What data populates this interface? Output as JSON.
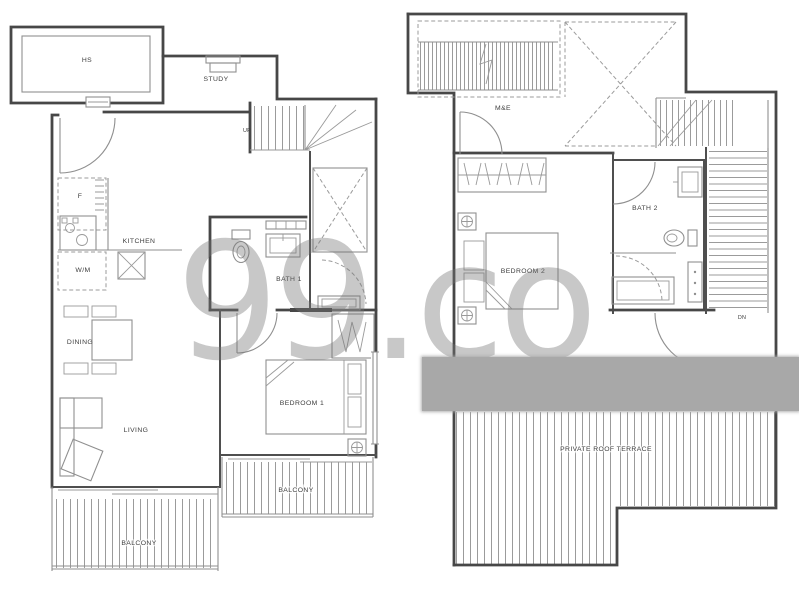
{
  "watermark": {
    "text": "99.co",
    "color": "#c9c9c9"
  },
  "censor_band": {
    "color": "#a8a8a8"
  },
  "colors": {
    "wall": "#474747",
    "fixture_line": "#8f8f8f",
    "label_text": "#3d3d3d",
    "background": "#ffffff"
  },
  "floor1": {
    "labels": {
      "hs": "HS",
      "study": "STUDY",
      "up": "UP",
      "fridge": "F",
      "kitchen": "KITCHEN",
      "washer": "W/M",
      "bath1": "BATH 1",
      "dining": "DINING",
      "living": "LIVING",
      "bedroom1": "BEDROOM 1",
      "balcony_living": "BALCONY",
      "balcony_bedroom": "BALCONY"
    }
  },
  "floor2": {
    "labels": {
      "mne": "M&E",
      "bedroom2": "BEDROOM 2",
      "bath2": "BATH 2",
      "down": "DN",
      "terrace": "PRIVATE ROOF TERRACE"
    }
  }
}
